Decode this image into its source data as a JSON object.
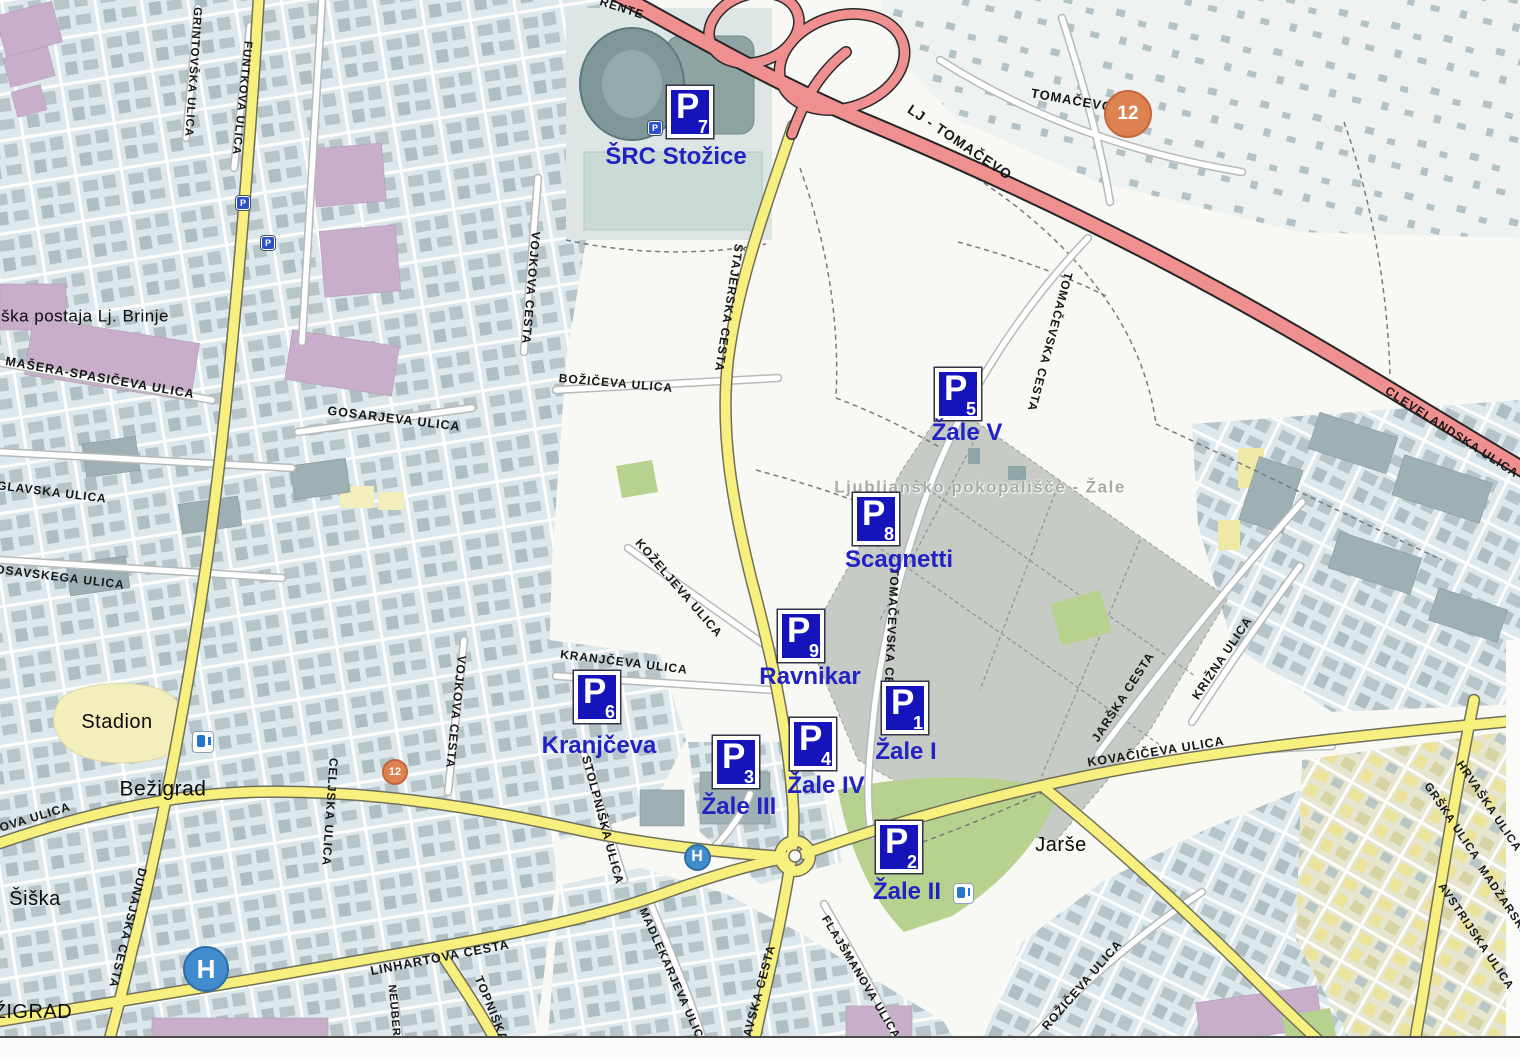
{
  "marker_letter": "P",
  "markers": [
    {
      "sub": "7",
      "name": "ŠRC Stožice",
      "x": 690,
      "y": 112,
      "cx": 676,
      "cy": 157
    },
    {
      "sub": "5",
      "name": "Žale V",
      "x": 958,
      "y": 394,
      "cx": 967,
      "cy": 433
    },
    {
      "sub": "8",
      "name": "Scagnetti",
      "x": 876,
      "y": 519,
      "cx": 899,
      "cy": 560
    },
    {
      "sub": "9",
      "name": "Ravnikar",
      "x": 801,
      "y": 636,
      "cx": 810,
      "cy": 677
    },
    {
      "sub": "6",
      "name": "Kranjčeva",
      "x": 597,
      "y": 697,
      "cx": 599,
      "cy": 746
    },
    {
      "sub": "1",
      "name": "Žale I",
      "x": 905,
      "y": 708,
      "cx": 906,
      "cy": 752
    },
    {
      "sub": "4",
      "name": "Žale IV",
      "x": 813,
      "y": 744,
      "cx": 826,
      "cy": 786
    },
    {
      "sub": "3",
      "name": "Žale III",
      "x": 736,
      "y": 762,
      "cx": 739,
      "cy": 807
    },
    {
      "sub": "2",
      "name": "Žale II",
      "x": 899,
      "y": 847,
      "cx": 907,
      "cy": 892
    }
  ],
  "street_labels": [
    {
      "t": "RENTE",
      "x": 622,
      "y": 8,
      "r": 18,
      "s": 12
    },
    {
      "t": "GRINTOVŠKA ULICA",
      "x": 192,
      "y": 72,
      "r": 94,
      "s": 11.5
    },
    {
      "t": "FUNTKOVA ULICA",
      "x": 241,
      "y": 98,
      "r": 96,
      "s": 11.5
    },
    {
      "t": "MAŠERA-SPASIČEVA ULICA",
      "x": 100,
      "y": 378,
      "r": 10,
      "s": 12.5
    },
    {
      "t": "GOSARJEVA ULICA",
      "x": 394,
      "y": 419,
      "r": 7,
      "s": 12.5
    },
    {
      "t": "GLAVSKA ULICA",
      "x": 52,
      "y": 492,
      "r": 7,
      "s": 12
    },
    {
      "t": "OSAVSKEGA ULICA",
      "x": 60,
      "y": 577,
      "r": 7,
      "s": 12
    },
    {
      "t": "BOŽIČEVA ULICA",
      "x": 616,
      "y": 383,
      "r": 5,
      "s": 12
    },
    {
      "t": "VOJKOVA CESTA",
      "x": 531,
      "y": 288,
      "r": 95,
      "s": 12
    },
    {
      "t": "ŠTAJERSKA CESTA",
      "x": 729,
      "y": 308,
      "r": 99,
      "s": 12
    },
    {
      "t": "KOŽELJEVA ULICA",
      "x": 679,
      "y": 588,
      "r": 49,
      "s": 12
    },
    {
      "t": "TOMAČEVSKA CESTA",
      "x": 1050,
      "y": 342,
      "r": 105,
      "s": 12
    },
    {
      "t": "TOMAČEVSKA CESTA",
      "x": 891,
      "y": 640,
      "r": 93,
      "s": 12
    },
    {
      "t": "KRANJČEVA ULICA",
      "x": 624,
      "y": 662,
      "r": 7,
      "s": 12
    },
    {
      "t": "VOJKOVA CESTA",
      "x": 456,
      "y": 712,
      "r": 96,
      "s": 12
    },
    {
      "t": "STOLPNIŠKA ULICA",
      "x": 603,
      "y": 820,
      "r": 75,
      "s": 12
    },
    {
      "t": "CELJSKA ULICA",
      "x": 330,
      "y": 812,
      "r": 94,
      "s": 12
    },
    {
      "t": "DUNAJSKA CESTA",
      "x": 128,
      "y": 928,
      "r": 104,
      "s": 12
    },
    {
      "t": "OVA ULICA",
      "x": 35,
      "y": 817,
      "r": -17,
      "s": 12
    },
    {
      "t": "LINHARTOVA CESTA",
      "x": 440,
      "y": 958,
      "r": -11,
      "s": 12.5
    },
    {
      "t": "NEUBERGERJEVA",
      "x": 396,
      "y": 1040,
      "r": 85,
      "s": 11
    },
    {
      "t": "TOPNIŠKA ULICA",
      "x": 500,
      "y": 1030,
      "r": 68,
      "s": 12
    },
    {
      "t": "MADLEKARJEVA ULICA",
      "x": 672,
      "y": 978,
      "r": 66,
      "s": 11.5
    },
    {
      "t": "SAVSKA CESTA",
      "x": 758,
      "y": 995,
      "r": -75,
      "s": 12
    },
    {
      "t": "FLAJŠMANOVA ULICA",
      "x": 860,
      "y": 978,
      "r": 59,
      "s": 11.5
    },
    {
      "t": "ROŽIČEVA ULICA",
      "x": 1082,
      "y": 985,
      "r": -49,
      "s": 12
    },
    {
      "t": "KOVAČIČEVA ULICA",
      "x": 1156,
      "y": 752,
      "r": -9,
      "s": 12.5
    },
    {
      "t": "JARŠKA CESTA",
      "x": 1123,
      "y": 697,
      "r": -57,
      "s": 12
    },
    {
      "t": "KRIŽNA ULICA",
      "x": 1222,
      "y": 658,
      "r": -56,
      "s": 12
    },
    {
      "t": "HRVAŠKA ULICA",
      "x": 1488,
      "y": 807,
      "r": 56,
      "s": 11.5
    },
    {
      "t": "GRŠKA ULICA",
      "x": 1451,
      "y": 822,
      "r": 56,
      "s": 11.5
    },
    {
      "t": "MADŽARSKA",
      "x": 1503,
      "y": 902,
      "r": 56,
      "s": 11.5
    },
    {
      "t": "AVSTRIJSKA ULICA",
      "x": 1475,
      "y": 937,
      "r": 56,
      "s": 11.5
    },
    {
      "t": "CLEVELANDSKA ULICA",
      "x": 1452,
      "y": 432,
      "r": 33,
      "s": 12
    },
    {
      "t": "LJ - TOMAČEVO",
      "x": 960,
      "y": 142,
      "r": 34,
      "s": 14
    },
    {
      "t": "TOMAČEVO",
      "x": 1072,
      "y": 100,
      "r": 10,
      "s": 13
    }
  ],
  "place_labels": [
    {
      "t": "Stadion",
      "x": 117,
      "y": 722,
      "s": 20,
      "cls": "plabel"
    },
    {
      "t": "Bežigrad",
      "x": 163,
      "y": 789,
      "s": 21,
      "cls": "plabel"
    },
    {
      "t": "Šiška",
      "x": 35,
      "y": 899,
      "s": 20,
      "cls": "plabel"
    },
    {
      "t": "EŽIGRAD",
      "x": 26,
      "y": 1012,
      "s": 20,
      "cls": "plabel"
    },
    {
      "t": "Jarše",
      "x": 1061,
      "y": 845,
      "s": 20,
      "cls": "plabel"
    },
    {
      "t": "ška postaja Lj. Brinje",
      "x": 85,
      "y": 316,
      "s": 17,
      "cls": "plabel"
    },
    {
      "t": "Ljubljansko pokopališče - Žale",
      "x": 980,
      "y": 487,
      "s": 17,
      "cls": "ghost"
    }
  ],
  "poi": [
    {
      "k": "hospital",
      "t": "H",
      "x": 206,
      "y": 969,
      "d": 46,
      "fs": 26
    },
    {
      "k": "hospital",
      "t": "H",
      "x": 697,
      "y": 857,
      "d": 27,
      "fs": 16
    },
    {
      "k": "fuel",
      "t": "",
      "x": 203,
      "y": 742,
      "d": 22,
      "fs": 0
    },
    {
      "k": "fuel",
      "t": "",
      "x": 963,
      "y": 893,
      "d": 21,
      "fs": 0
    },
    {
      "k": "transit",
      "t": "12",
      "x": 1128,
      "y": 114,
      "d": 48,
      "fs": 19
    },
    {
      "k": "transit",
      "t": "12",
      "x": 395,
      "y": 772,
      "d": 26,
      "fs": 11
    },
    {
      "k": "minipark",
      "t": "P",
      "x": 243,
      "y": 203,
      "d": 14,
      "fs": 9
    },
    {
      "k": "minipark",
      "t": "P",
      "x": 268,
      "y": 243,
      "d": 14,
      "fs": 9
    },
    {
      "k": "minipark",
      "t": "P",
      "x": 655,
      "y": 128,
      "d": 14,
      "fs": 9
    }
  ],
  "colors": {
    "marker_blue": "#1414ba",
    "caption_blue": "#2222c4",
    "road_yellow": "#f8f07e",
    "highway_red": "#ef8f8f",
    "park_green": "#b7d28e",
    "cemetery_gray": "#c7cbc5",
    "residential": "#dce8eb"
  }
}
